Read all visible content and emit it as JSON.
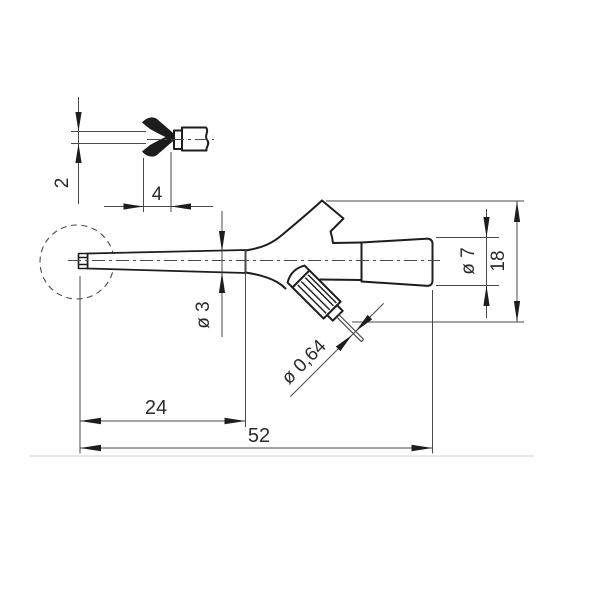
{
  "drawing": {
    "kind": "dimensioned-technical-drawing",
    "subject": "test-hook-probe",
    "labels": {
      "hook_opening": "2",
      "hook_protrusion": "4",
      "probe_diameter": "ø 3",
      "sleeve_diameter": "ø 7",
      "body_height": "18",
      "pin_diameter": "ø 0,64",
      "tip_length": "24",
      "overall_length": "52"
    },
    "colors": {
      "outline": "#1d1d1d",
      "dimension_lines": "#4a4a4a",
      "text": "#2b2b2b",
      "background": "#ffffff",
      "baseline": "#d9d9d9"
    }
  }
}
